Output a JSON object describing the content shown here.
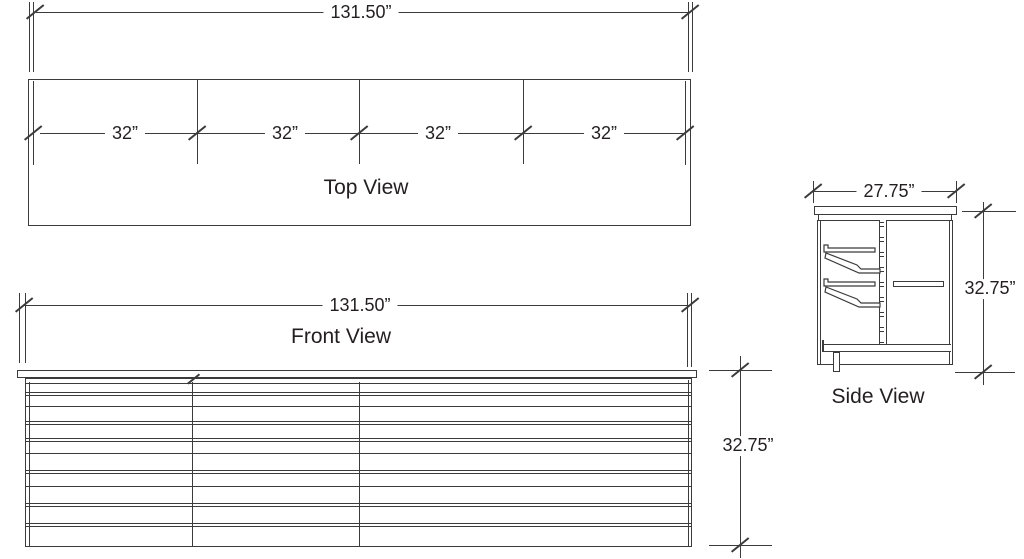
{
  "colors": {
    "line": "#3b3b3b",
    "text": "#231f20",
    "background": "#ffffff"
  },
  "views": {
    "top": {
      "label": "Top View",
      "width_dim": "131.50”",
      "section_dims": [
        "32”",
        "32”",
        "32”",
        "32”"
      ]
    },
    "front": {
      "label": "Front View",
      "width_dim": "131.50”",
      "height_dim": "32.75”"
    },
    "side": {
      "label": "Side View",
      "width_dim": "27.75”",
      "height_dim": "32.75”"
    }
  }
}
